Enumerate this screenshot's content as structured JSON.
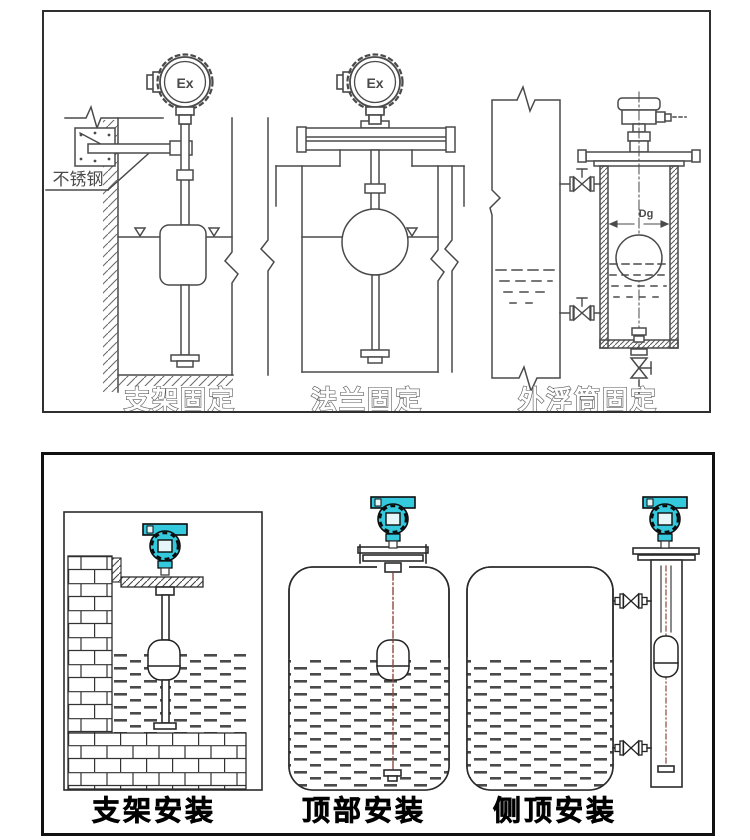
{
  "top_panel": {
    "diagrams": [
      {
        "caption": "支架固定",
        "head_label": "Ex",
        "material_note": "不锈钢"
      },
      {
        "caption": "法兰固定",
        "head_label": "Ex"
      },
      {
        "caption": "外浮筒固定",
        "dim_label": "Dg"
      }
    ]
  },
  "bottom_panel": {
    "diagrams": [
      {
        "caption": "支架安装"
      },
      {
        "caption": "顶部安装"
      },
      {
        "caption": "侧顶安装"
      }
    ]
  },
  "colors": {
    "transmitter_head_teal": "#35c9de",
    "diagram_line_gray": "#4a4a4a",
    "centerline_red": "#8b4a3e",
    "caption_color": "#000000"
  }
}
